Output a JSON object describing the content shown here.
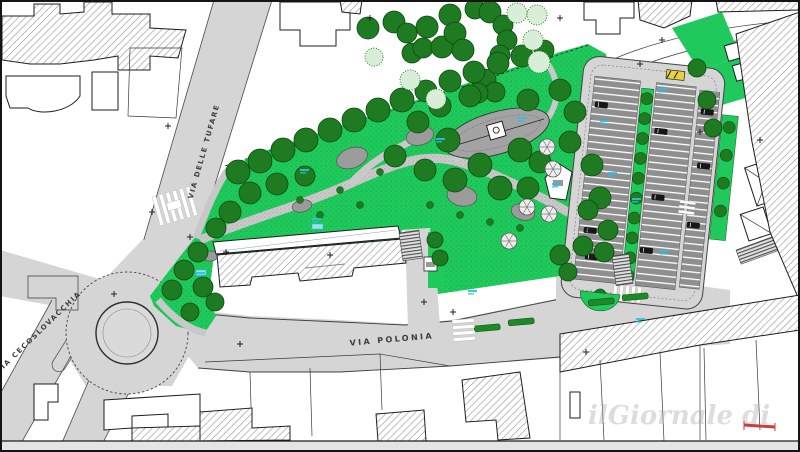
{
  "map": {
    "street_labels": {
      "tufare": "VIA DELLE TUFARE",
      "cecoslovacchia": "VIA CECOSLOVACCHIA",
      "polonia": "VIA  POLONIA"
    },
    "watermark": "ilGiornale di",
    "colors": {
      "road": "#d5d5d5",
      "park": "#1fc95b",
      "tree": "#1e7b22",
      "tree_outline": "#0c4a10",
      "stall": "#8f8f8f",
      "plaza": "#a3a3a3",
      "cyan": "#2bc0e0",
      "red_marker": "#d23b3b",
      "hedge": "#1c8a26",
      "bus_shelter_yellow": "#e6d23e"
    },
    "symbols": {
      "survey_marker": "+"
    }
  }
}
